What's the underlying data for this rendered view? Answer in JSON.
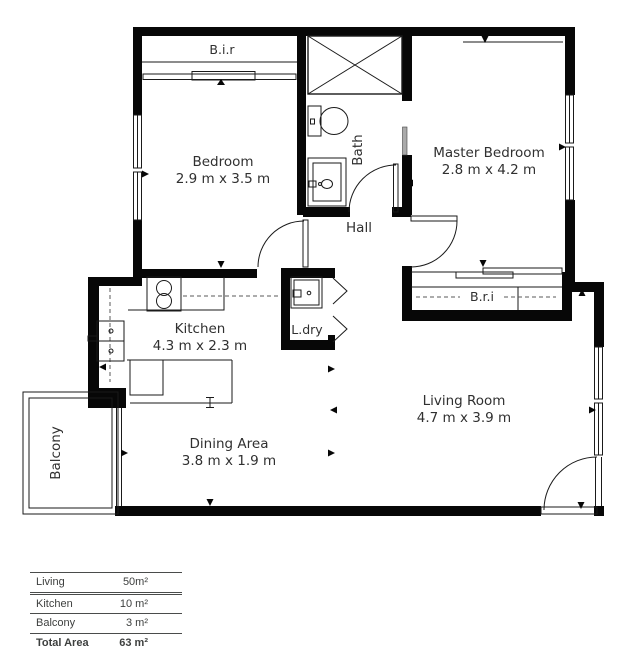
{
  "plan": {
    "rooms": {
      "bir": {
        "label": "B.i.r"
      },
      "bedroom": {
        "name": "Bedroom",
        "dims": "2.9 m x 3.5 m"
      },
      "bath": {
        "label": "Bath"
      },
      "hall": {
        "label": "Hall"
      },
      "master": {
        "name": "Master Bedroom",
        "dims": "2.8 m x 4.2 m"
      },
      "bri": {
        "label": "B.r.i"
      },
      "ldry": {
        "label": "L.dry"
      },
      "kitchen": {
        "name": "Kitchen",
        "dims": "4.3 m x 2.3 m"
      },
      "living": {
        "name": "Living Room",
        "dims": "4.7 m x 3.9 m"
      },
      "dining": {
        "name": "Dining Area",
        "dims": "3.8 m x 1.9 m"
      },
      "balcony": {
        "label": "Balcony"
      }
    },
    "colors": {
      "wall": "#070707",
      "label": "#303030"
    }
  },
  "area_table": {
    "rows": [
      {
        "label": "Living",
        "value": "50m²"
      },
      {
        "label": "Kitchen",
        "value": "10 m²"
      },
      {
        "label": "Balcony",
        "value": "3 m²"
      },
      {
        "label": "Total Area",
        "value": "63 m²"
      }
    ]
  }
}
